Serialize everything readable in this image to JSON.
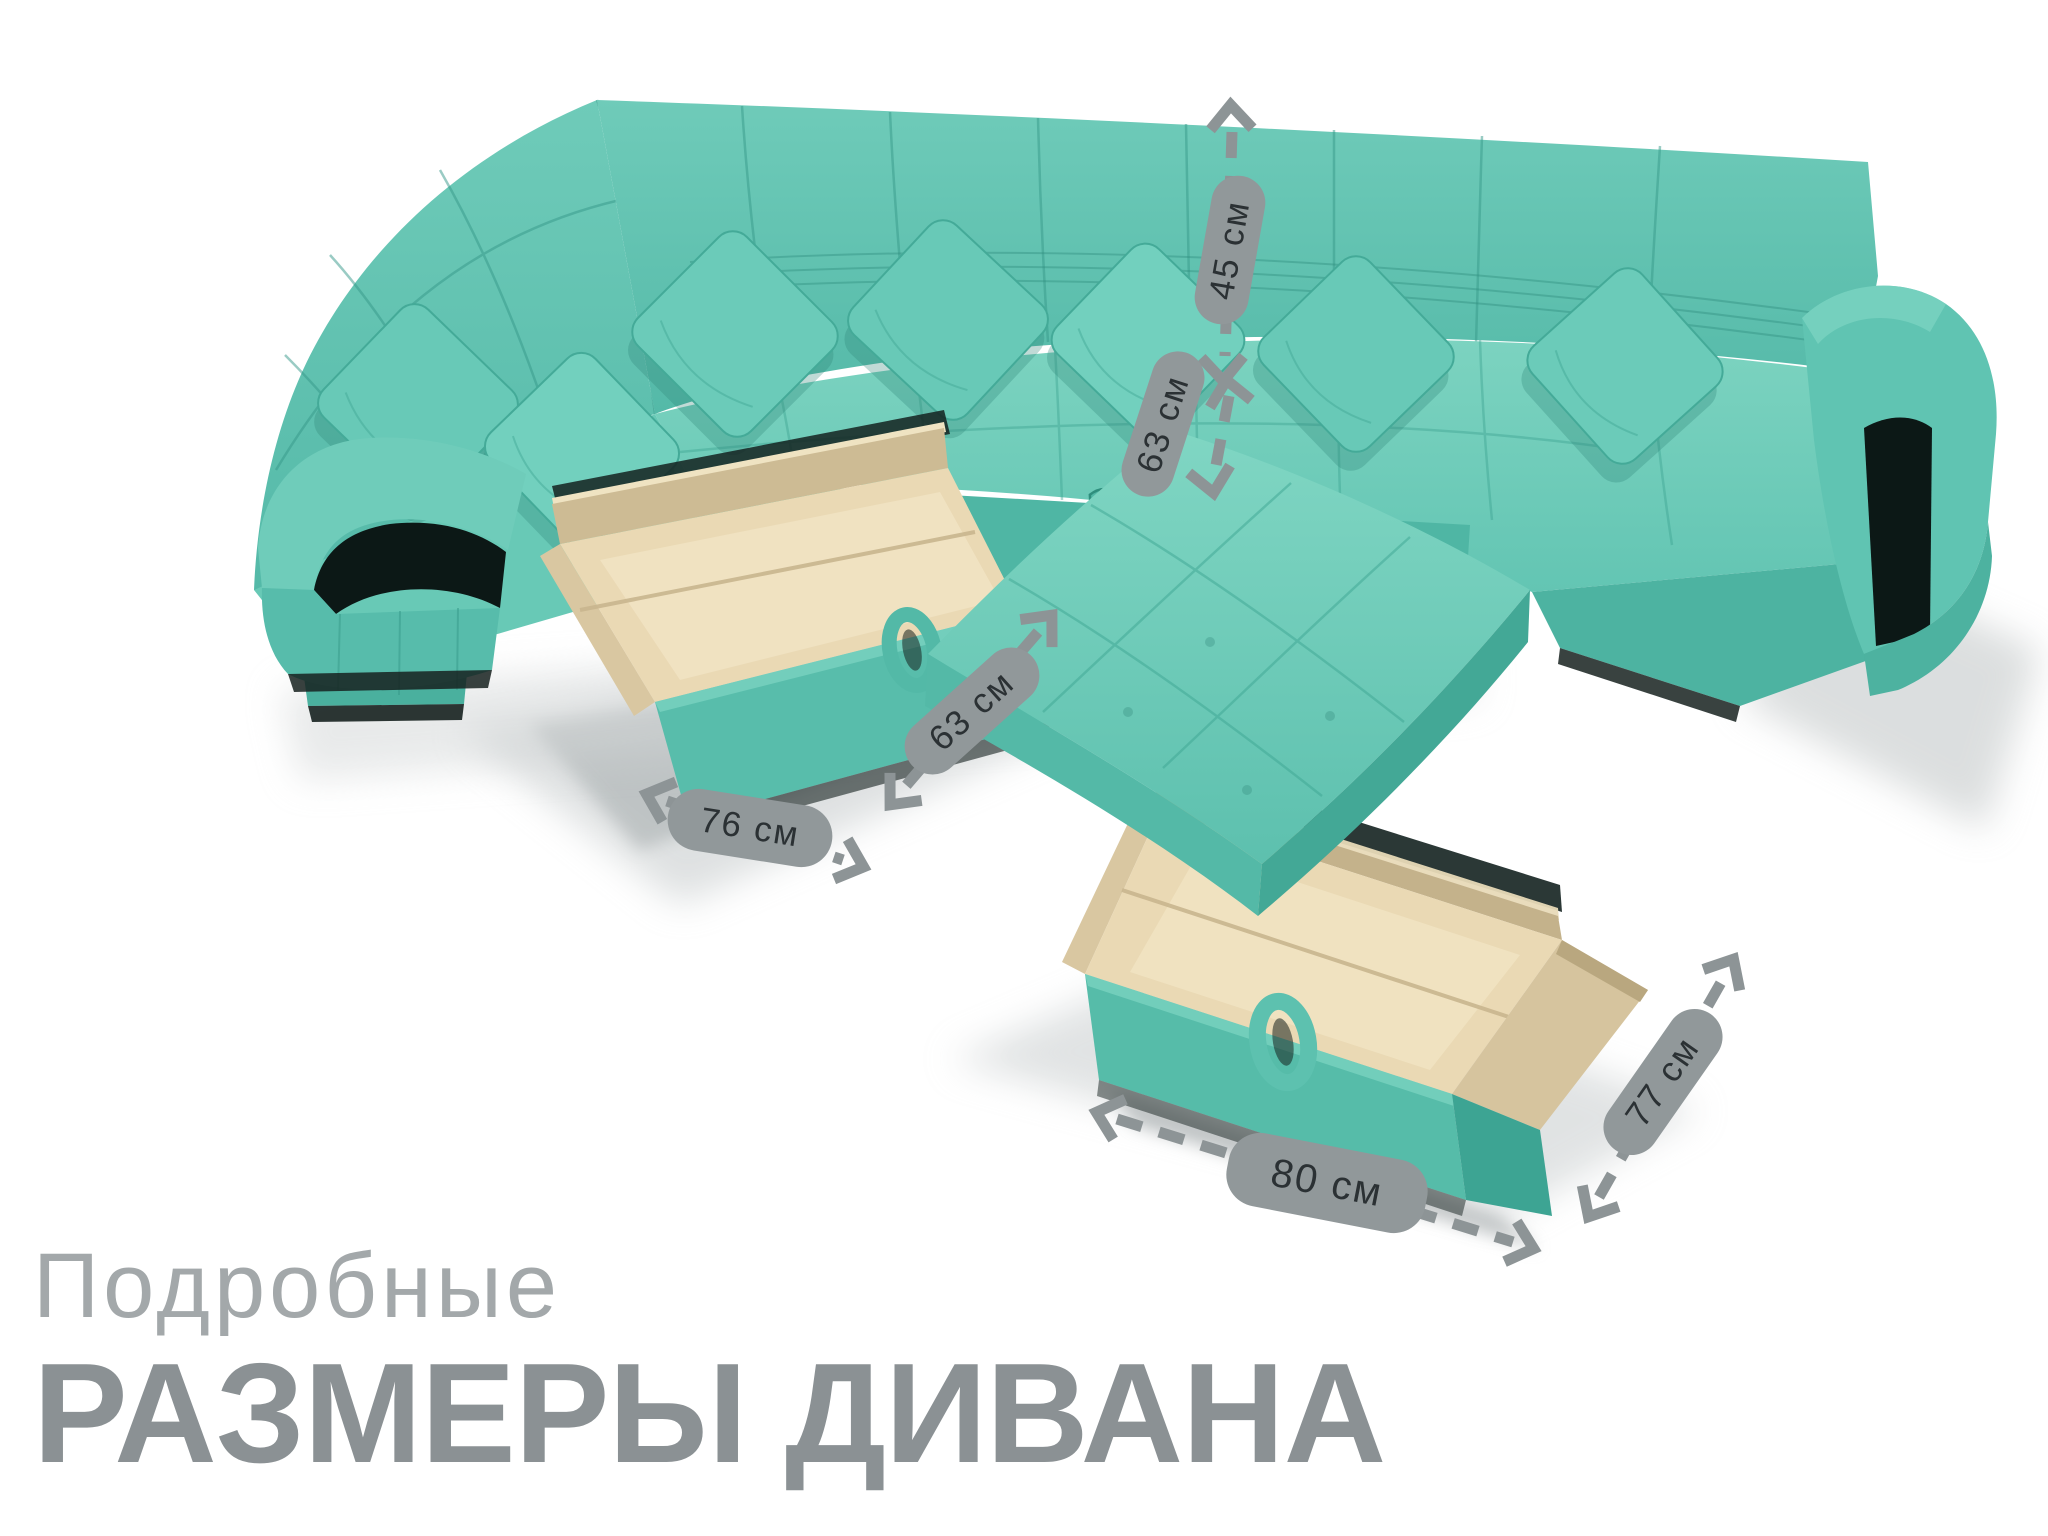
{
  "title": {
    "line1": "Подробные",
    "line2": "РАЗМЕРЫ ДИВАНА"
  },
  "dimensions": {
    "back_height": "45 см",
    "seat_height": "63 см",
    "left_drawer_depth": "63 см",
    "left_drawer_width": "76 см",
    "right_drawer_depth": "77 см",
    "right_drawer_width": "80 см"
  },
  "colors": {
    "fabric": "#5ec2b0",
    "fabric_light": "#88d8c6",
    "fabric_dark": "#3da794",
    "fabric_shadow": "#0c1816",
    "drawer_wood": "#e8d9b4",
    "drawer_wood_dark": "#cdbb94",
    "label_background": "#91989a",
    "label_text": "#2b3134",
    "arrow": "#8d9496",
    "title_light": "#a3a8aa",
    "title_bold": "#8b9194",
    "page_background": "#ffffff"
  }
}
